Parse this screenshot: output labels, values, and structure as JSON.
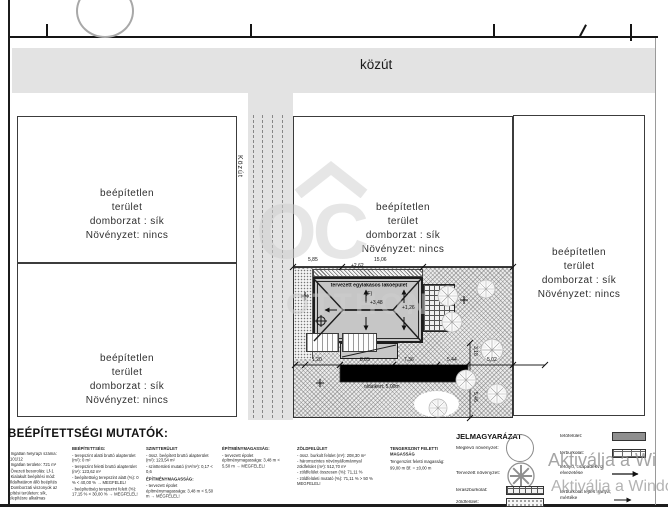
{
  "sheet": {
    "road_top_label": "közút",
    "road_side_label": "Közút"
  },
  "colors": {
    "road_gray": "#e3e3e3",
    "roof_gray": "#c6c6c6",
    "legend_roof_swatch": "#8f8f8f",
    "watermark_gray": "#cfcfcf"
  },
  "parcels": [
    {
      "lines": [
        "beépítetlen",
        "terület",
        "domborzat : sík",
        "Növényzet: nincs"
      ]
    },
    {
      "lines": [
        "beépítetlen",
        "terület",
        "domborzat : sík",
        "Növényzet: nincs"
      ]
    },
    {
      "lines": [
        "beépítetlen",
        "terület",
        "domborzat : sík",
        "Növényzet: nincs"
      ]
    },
    {
      "lines": [
        "beépítetlen",
        "terület",
        "domborzat : sík",
        "Növényzet: nincs"
      ]
    }
  ],
  "site_plan": {
    "building_label": "tervezett egylakásos lakóépület",
    "building_label_2": "(F)",
    "elevation_ridge": "+3,48",
    "elevation_eave": "+1,26",
    "dims_top": [
      "5,85",
      "15,06"
    ],
    "dim_top_offset": "+2,62",
    "dims_bottom": [
      "1,20",
      "8,05",
      "7,36",
      "5,44",
      "5,02"
    ],
    "dims_right": [
      "3,18",
      "5,46"
    ],
    "side_yard_label": "oldalkert: 5,00m"
  },
  "indicators": {
    "title": "BEÉPÍTETTSÉGI MUTATÓK:",
    "col1": {
      "lines": [
        "- Ingatlan helyrajzi száma: 1101/12",
        "- Ingatlan területe: 721 m²",
        "- Övezeti besorolás: Lf-1",
        "- Kialakult beépítési mód: Oldalhatáron álló beépítés",
        "- Domborzati viszonyok az építési területen: sík, telepítésre alkalmas"
      ]
    },
    "col2": {
      "heading": "BEÉPÍTETTSÉG:",
      "lines": [
        "- terepszint alatti bruttó alapterület (m²): 0 m²",
        "- terepszint feletti bruttó alapterület (m²): 123,62 m²",
        "- beépítettség terepszint alatt (%): 0 % < 40,00 % → MEGFELEL!",
        "- beépítettség terepszint felett (%): 17,15 % < 30,00 % → MEGFELEL!"
      ]
    },
    "col3": {
      "heading": "SZINTTERÜLET",
      "lines": [
        "- össz. beépített bruttó alapterület (m²): 123,54 m²",
        "- szintterületi mutató (m²/m²): 0,17 < 0,6"
      ],
      "heading2": "ÉPÍTMÉNYMAGASSÁG:",
      "lines2": [
        "- tervezett épület építménymagassága: 3,48 m < 5,50 m → MEGFELEL!"
      ]
    },
    "col4": {
      "heading": "ÉPÍTMÉNYMAGASSÁG:",
      "lines": [
        "- tervezett épület építménymagassága: 3,48 m < 5,50 m → MEGFELEL!"
      ]
    },
    "col5": {
      "heading": "ZÖLDFELÜLET",
      "lines": [
        "- össz. burkolt felület (m²): 208,30 m²",
        "- háromszintes növényállománnyal zöldfelület (m²): 512,70 m²",
        "- zöldfelület összesen (%): 71,11 %",
        "- zöldfelületi mutató (%): 71,11 % > 50 % MEGFELEL!"
      ]
    },
    "col6": {
      "heading": "TENGERSZINT FELETTI MAGASSÁG",
      "lines": [
        "Tengerszint feletti magasság:",
        "99,00 m Bf. = ±0,00 m"
      ]
    }
  },
  "legend": {
    "title": "JELMAGYARÁZAT",
    "left": [
      {
        "label": "Meglévő növényzet:"
      },
      {
        "label": "Tervezett növényzet:"
      },
      {
        "label": "teraszburkolat:"
      },
      {
        "label": "zöldfelület:"
      }
    ],
    "right": [
      {
        "label": "tetőfelület:"
      },
      {
        "label": "térburkolat:"
      },
      {
        "label": "lefolyó, csapadékvíz elvezetése"
      },
      {
        "label": "térburkolat lejtés iránya, mértéke"
      }
    ]
  },
  "watermarks": {
    "logo": "OC",
    "logo_sub": "OTTHON",
    "win_line1": "Aktiválja a Wi",
    "win_line2": "Aktiválja a Windo"
  }
}
